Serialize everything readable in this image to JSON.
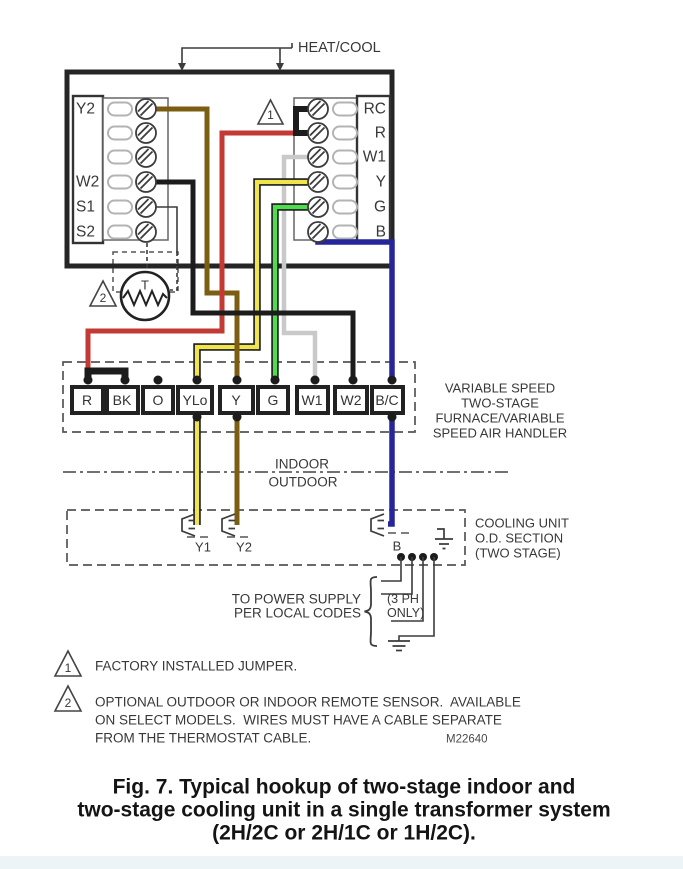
{
  "thermostat": {
    "heat_cool_label": "HEAT/COOL",
    "left_terminals": [
      "Y2",
      "",
      "",
      "W2",
      "S1",
      "S2"
    ],
    "right_terminals": [
      "RC",
      "R",
      "W1",
      "Y",
      "G",
      "B"
    ],
    "sensor_label": "T"
  },
  "furnace": {
    "terminals": [
      "R",
      "BK",
      "O",
      "YLo",
      "Y",
      "G",
      "W1",
      "W2",
      "B/C"
    ],
    "description_lines": [
      "VARIABLE SPEED",
      "TWO-STAGE",
      "FURNACE/VARIABLE",
      "SPEED AIR HANDLER"
    ]
  },
  "divider": {
    "indoor": "INDOOR",
    "outdoor": "OUTDOOR"
  },
  "cooling_unit": {
    "connectors": [
      "Y1",
      "Y2",
      "B"
    ],
    "description_lines": [
      "COOLING UNIT",
      "O.D. SECTION",
      "(TWO STAGE)"
    ]
  },
  "power_supply": {
    "label_lines": [
      "TO POWER SUPPLY",
      "PER LOCAL CODES"
    ],
    "phase_note_lines": [
      "(3 PH",
      "ONLY)"
    ]
  },
  "notes": [
    {
      "marker": "1",
      "lines": [
        "FACTORY INSTALLED JUMPER."
      ]
    },
    {
      "marker": "2",
      "lines": [
        "OPTIONAL OUTDOOR OR INDOOR REMOTE SENSOR.  AVAILABLE",
        "ON SELECT MODELS.  WIRES MUST HAVE A CABLE SEPARATE",
        "FROM THE THERMOSTAT CABLE."
      ]
    }
  ],
  "doc_number": "M22640",
  "caption_lines": [
    "Fig. 7. Typical hookup of two-stage indoor and",
    "two-stage cooling unit in a single transformer system",
    "(2H/2C or 2H/1C or 1H/2C)."
  ],
  "wire_colors": {
    "red": "#c23a33",
    "brown": "#7c5e13",
    "yellow": "#efe44c",
    "green": "#4fdd4f",
    "gray": "#c9c9c9",
    "blue": "#26269a",
    "black": "#1c1c1c",
    "outline": "#1c1c1c"
  }
}
